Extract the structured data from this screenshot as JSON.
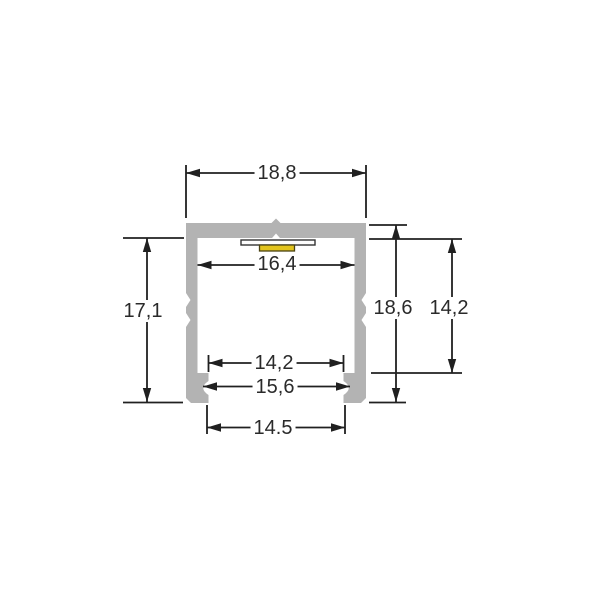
{
  "drawing": {
    "kind": "technical cross-section of LED aluminium mounting profile",
    "dimensions": {
      "top_width": "18,8",
      "inner_width": "16,4",
      "left_height": "17,1",
      "total_height": "18,6",
      "right_inner_height": "14,2",
      "bottom_inner_width": "14,2",
      "groove_width": "15,6",
      "bottom_width": "14.5"
    },
    "colors": {
      "profile_fill": "#b3b3b3",
      "led_pcb_fill": "#fdfdfd",
      "led_fill": "#e2c41d",
      "line_color": "#202020",
      "background": "#ffffff"
    }
  }
}
